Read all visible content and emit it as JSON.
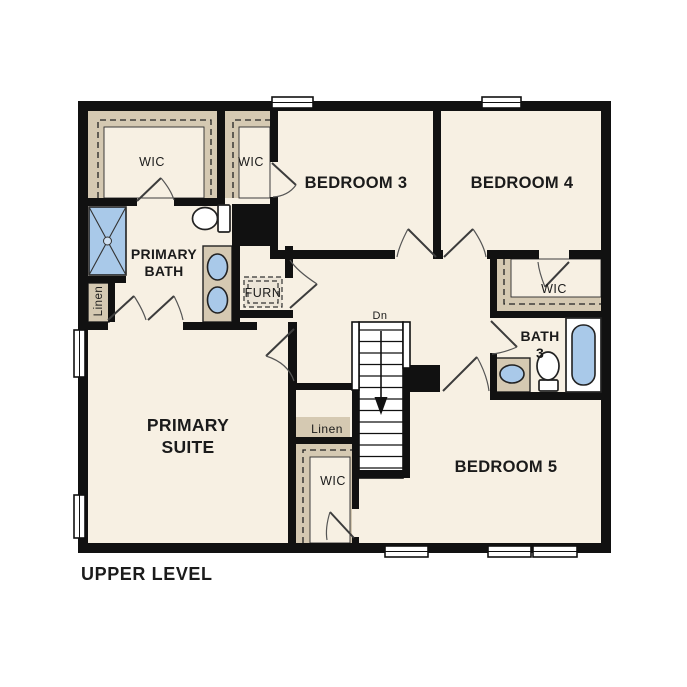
{
  "title": "UPPER LEVEL",
  "colors": {
    "background": "#ffffff",
    "walls": "#111111",
    "floor": "#f7f0e3",
    "closet_shelf_tan": "#d5c9b2",
    "fixture_blue": "#a9c9e9",
    "text": "#1b1b1b"
  },
  "rooms": {
    "primary_suite": {
      "line1": "PRIMARY",
      "line2": "SUITE"
    },
    "primary_bath": {
      "line1": "PRIMARY",
      "line2": "BATH"
    },
    "primary_wic": "WIC",
    "bedroom3": {
      "name": "BEDROOM 3",
      "closet": "WIC"
    },
    "bedroom4": {
      "name": "BEDROOM 4",
      "closet": "WIC"
    },
    "bedroom5": {
      "name": "BEDROOM 5",
      "closet": "WIC"
    },
    "bath3": {
      "line1": "BATH",
      "line2": "3"
    },
    "linen_bath": "Linen",
    "linen_hall": "Linen",
    "furnace": "FURN",
    "stairs": {
      "direction": "Dn"
    }
  }
}
